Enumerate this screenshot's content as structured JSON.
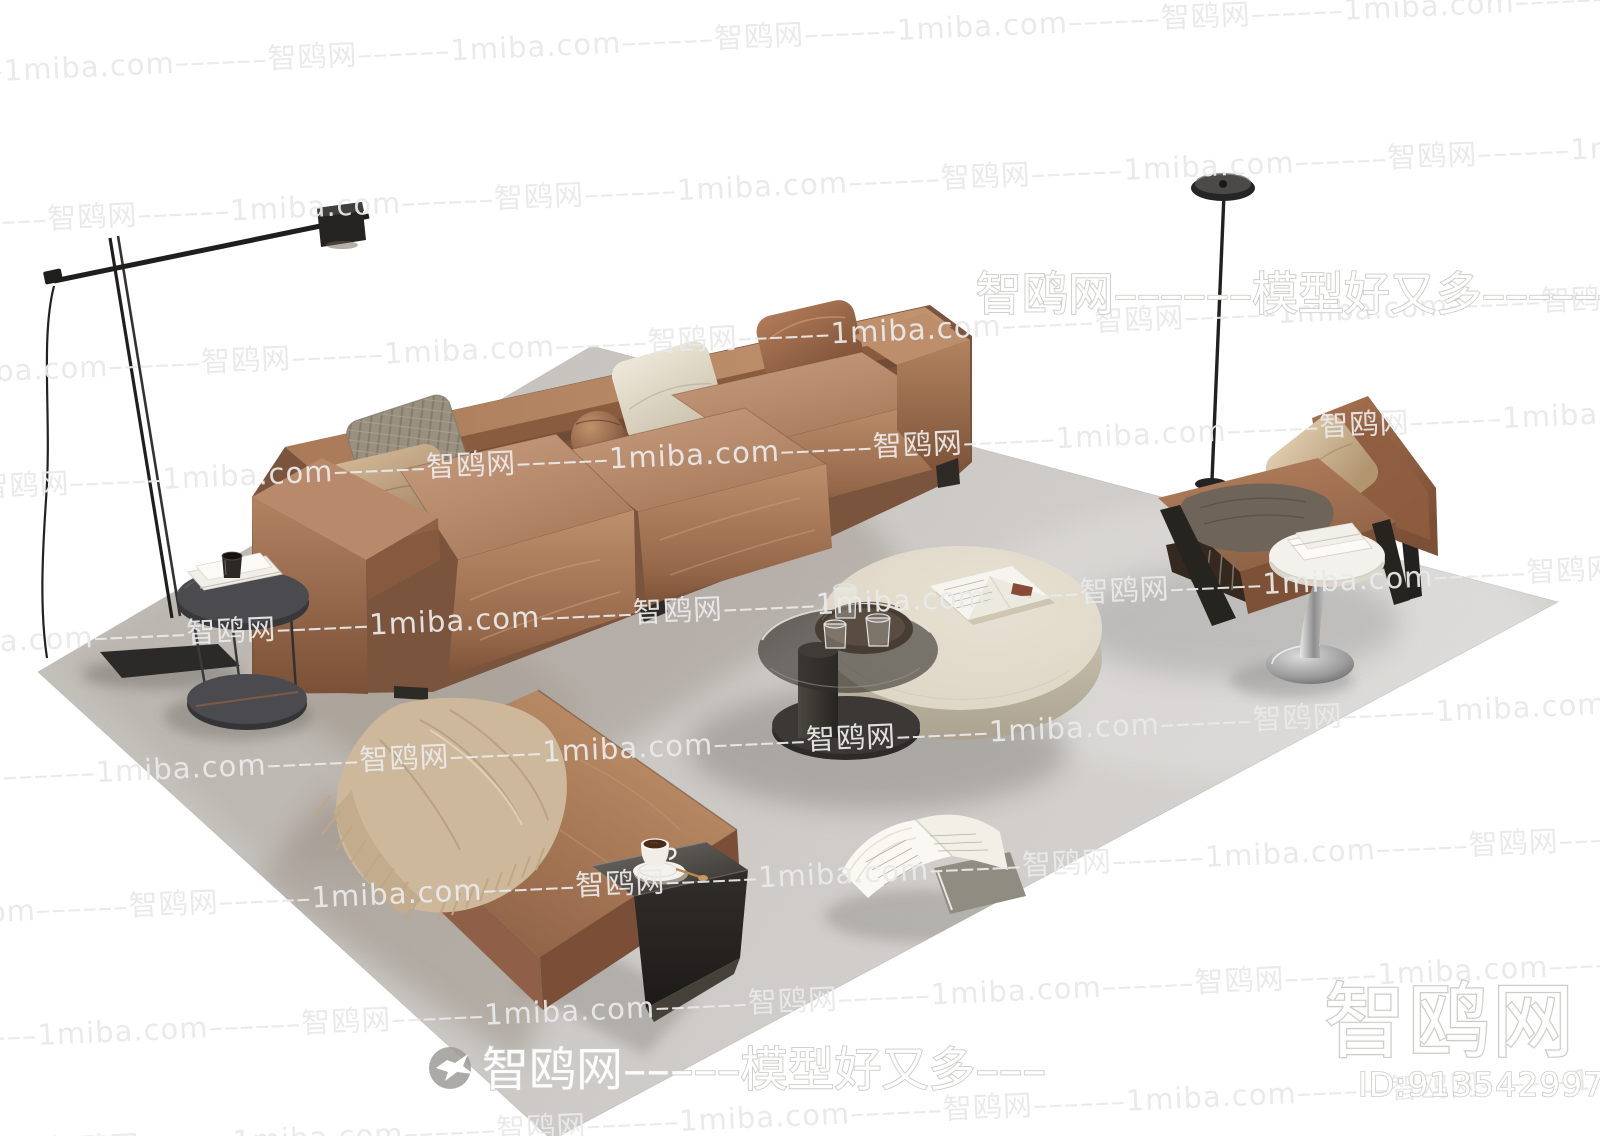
{
  "page": {
    "title": "Living room furniture set 3D render preview",
    "canvas": {
      "width": 1600,
      "height": 1136
    }
  },
  "watermarks": {
    "tile_row_text": "1miba.com––––––智鸥网––––––1miba.com––––––智鸥网––––––1miba.com––––––智鸥网––––––1miba.com––––––智鸥网––––––1miba.com––––––智鸥网––––––1miba.com",
    "brand_line_top": "智鸥网––––––模型好又多––––––",
    "brand_line_bottom": "智鸥网–––––模型好又多–––",
    "site_name": "智鸥网",
    "model_id": "ID:913542997",
    "tile_color": "#e9e9e9",
    "outline_color": "#cdccc8"
  },
  "scene": {
    "type": "living-room furniture 3D render on white background",
    "objects": [
      "three-seat brown leather sofa with pillows",
      "square leather pouf with fringed throw blanket",
      "round stone coffee table with smoked-glass lower tier",
      "wooden tray with water glasses",
      "open magazine on coffee table",
      "brown leather lounge armchair with metal frame",
      "white tulip side table with books",
      "dark round pedestal side table with books and cup",
      "black counterweight-arm floor lamp",
      "black disc-head floor lamp",
      "black bent-metal C side table with coffee cup",
      "open book on rug",
      "large gray area rug"
    ],
    "palette": {
      "leather": "#a97b5c",
      "leather_dark": "#7c5138",
      "rug": "#cdcac6",
      "stone": "#e0d9ca",
      "cream_pillow": "#e9e3d5",
      "blanket": "#cdb89c",
      "metal": "#262524"
    }
  }
}
